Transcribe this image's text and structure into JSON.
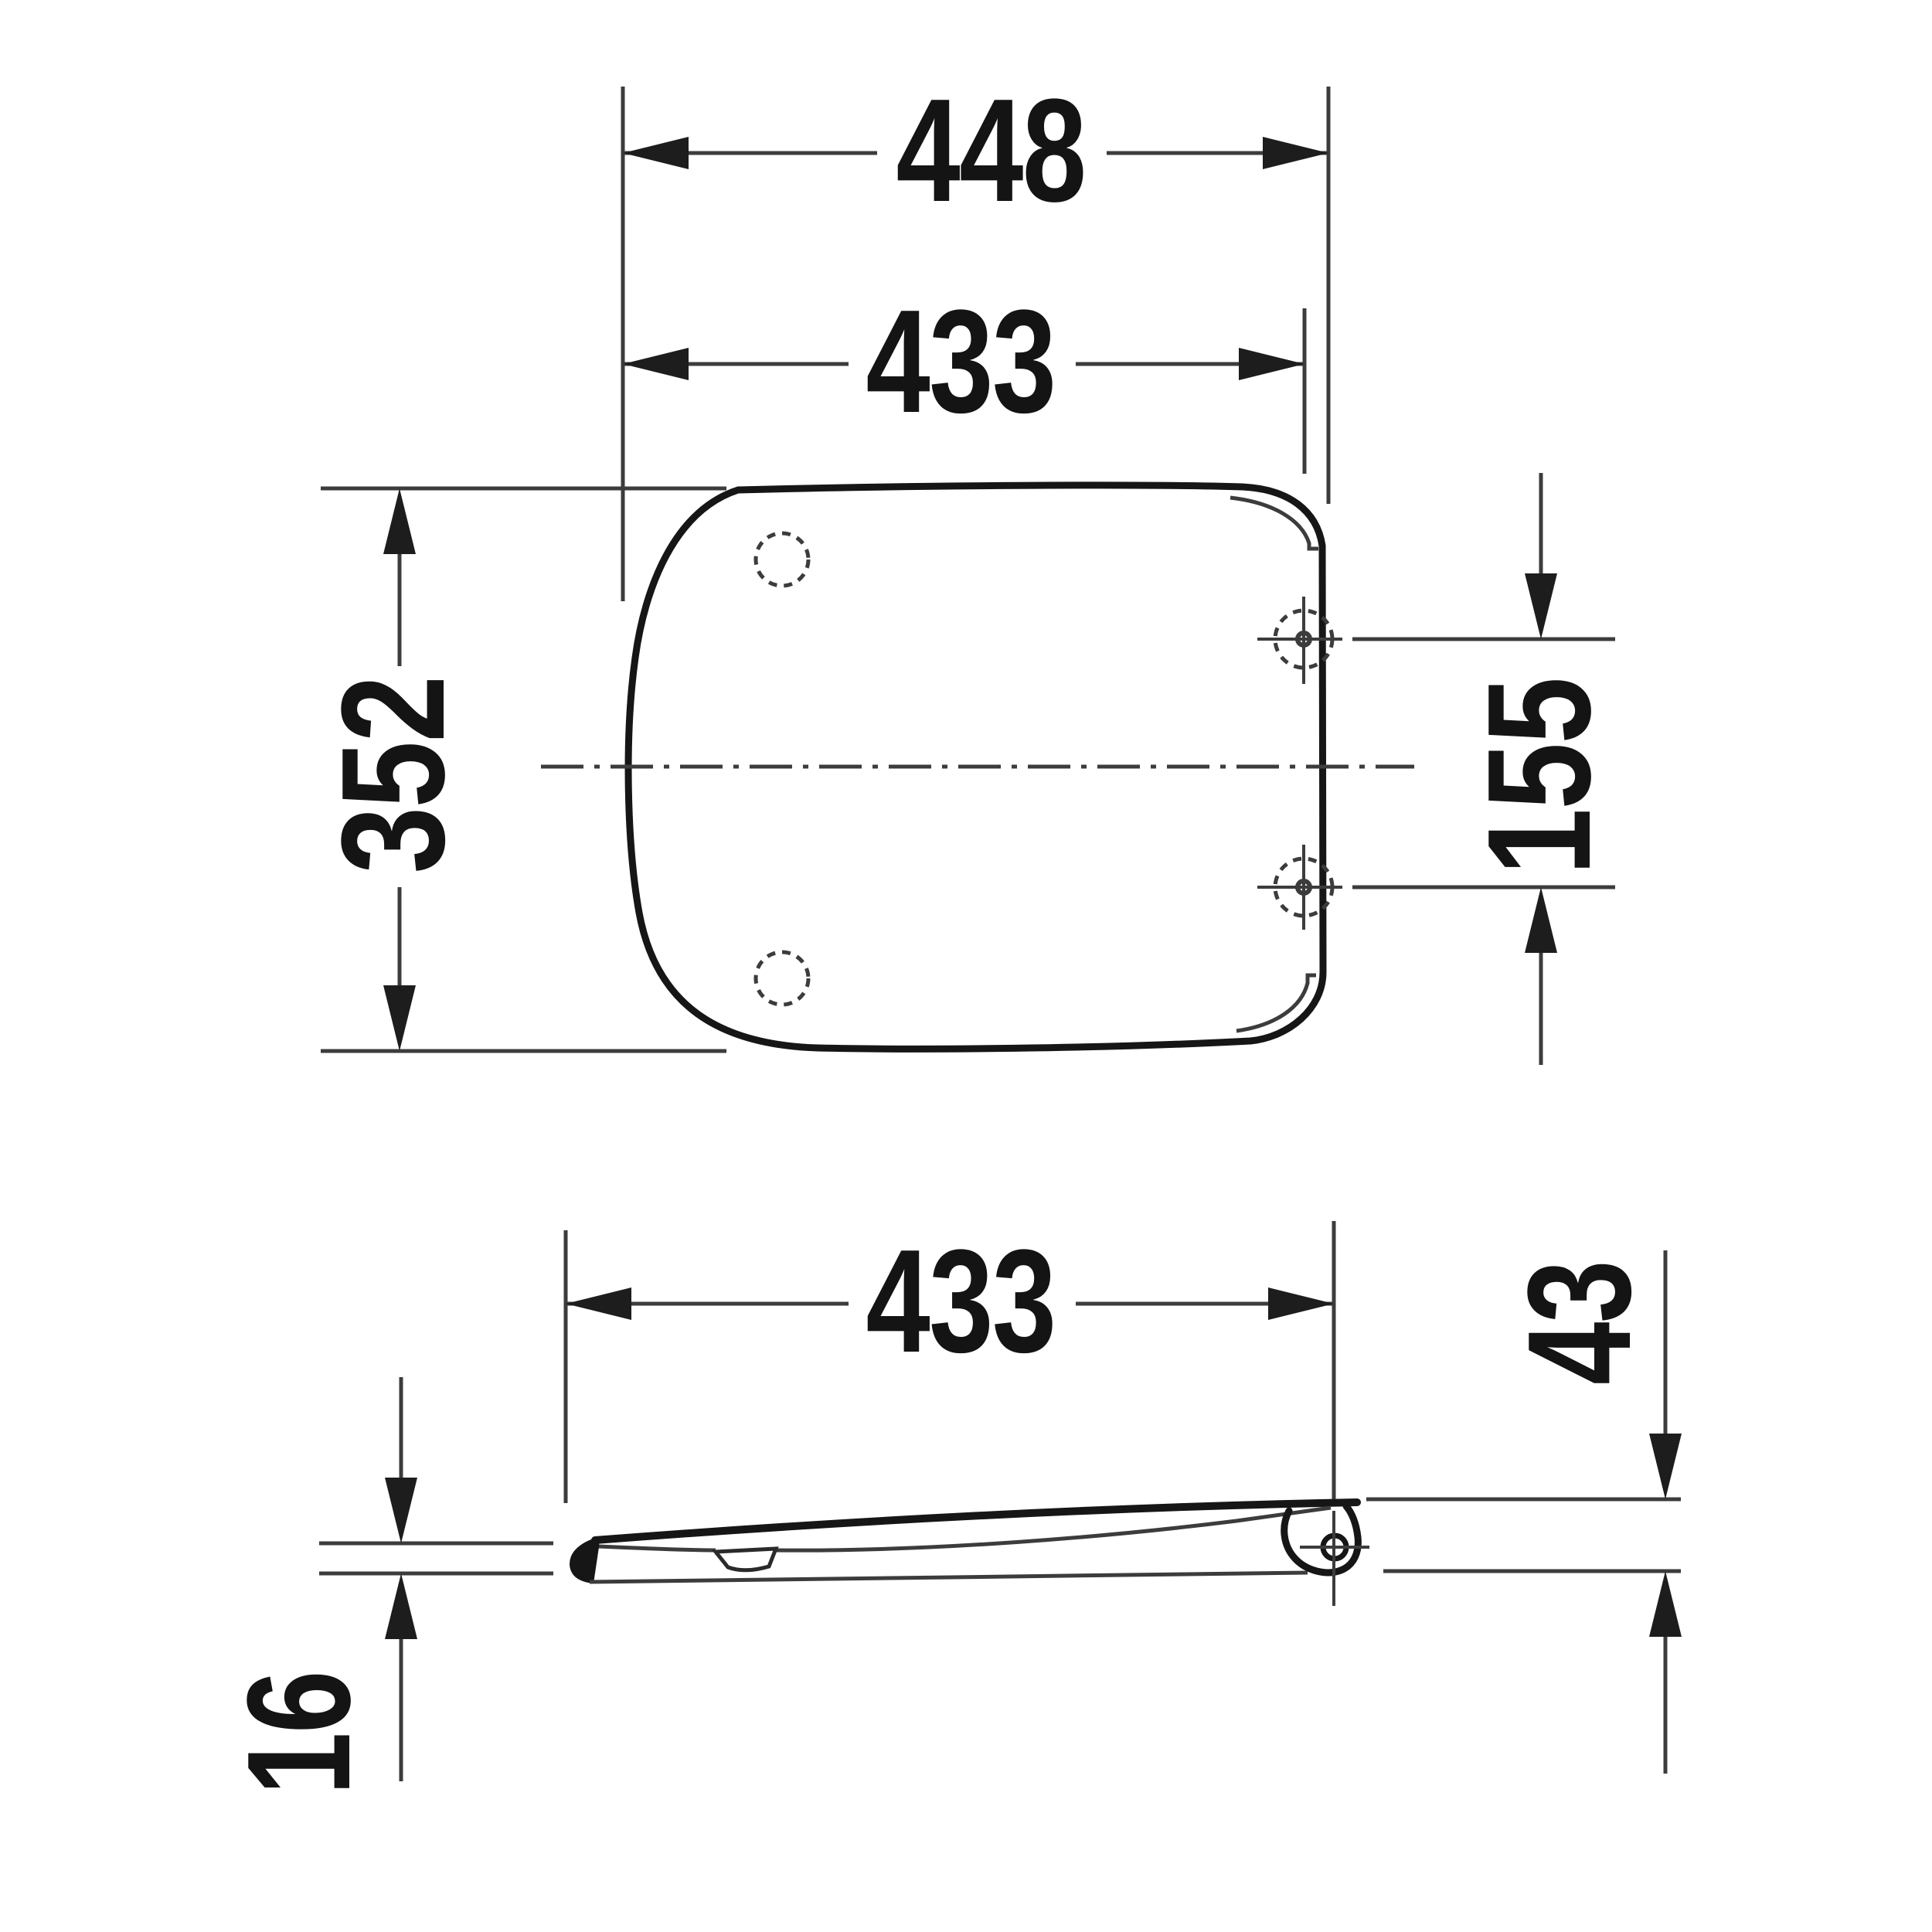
{
  "page": {
    "background": "#ffffff",
    "line_color": "#3c3c3c",
    "outline_color": "#161616",
    "text_color": "#141414"
  },
  "drawing": {
    "kind": "technical-dimension-drawing",
    "subject": "toilet seat and lid",
    "plan_view": {
      "dim_outer_width": {
        "label": "448"
      },
      "dim_hinge_width": {
        "label": "433"
      },
      "dim_depth": {
        "label": "352"
      },
      "dim_hole_spacing": {
        "label": "155"
      }
    },
    "side_view": {
      "dim_length": {
        "label": "433"
      },
      "dim_rear_height": {
        "label": "43"
      },
      "dim_front_thickness": {
        "label": "16"
      }
    }
  }
}
